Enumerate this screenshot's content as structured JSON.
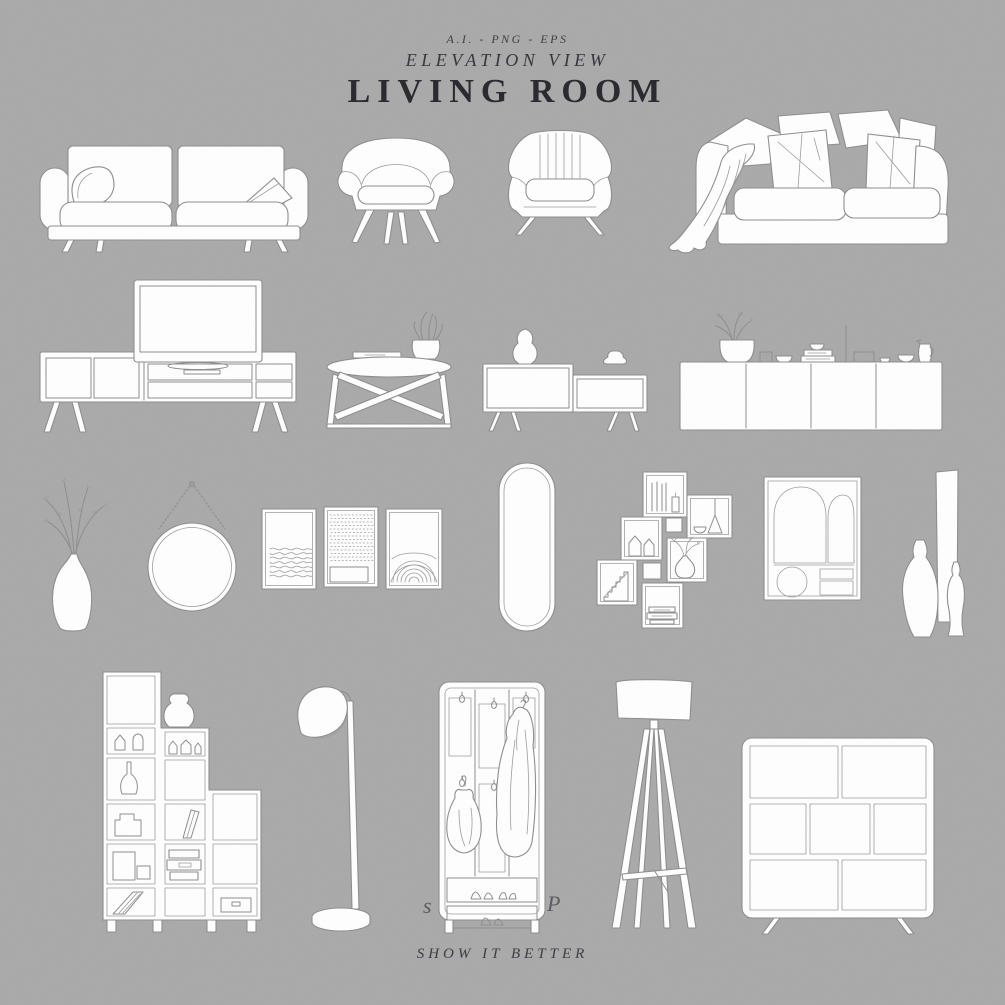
{
  "meta": {
    "width": 1005,
    "height": 1005
  },
  "colors": {
    "background": "#a9a9a9",
    "ink": "#2e2e34",
    "line": "#8d8d8d",
    "fill": "#ffffff"
  },
  "header": {
    "formats": "A.I. - PNG - EPS",
    "subtitle": "ELEVATION VIEW",
    "title": "LIVING ROOM"
  },
  "footer": {
    "brand": "SHOW IT BETTER"
  },
  "watermark": {
    "left_fragment": "s",
    "right_fragment": "P"
  },
  "items": [
    {
      "name": "three-seat-sofa"
    },
    {
      "name": "accent-armchair"
    },
    {
      "name": "channel-back-armchair"
    },
    {
      "name": "slipcover-sofa-with-throw"
    },
    {
      "name": "tv-stand-with-tv"
    },
    {
      "name": "round-coffee-table"
    },
    {
      "name": "two-tier-sideboard"
    },
    {
      "name": "long-sideboard-with-decor"
    },
    {
      "name": "vase-with-dried-branches"
    },
    {
      "name": "round-hanging-mirror"
    },
    {
      "name": "gallery-frames-trio"
    },
    {
      "name": "oval-floor-mirror"
    },
    {
      "name": "staggered-cube-shelf"
    },
    {
      "name": "abstract-art-frame"
    },
    {
      "name": "decorative-vases-group"
    },
    {
      "name": "stepped-bookshelf"
    },
    {
      "name": "dome-floor-lamp"
    },
    {
      "name": "hallway-coat-rack"
    },
    {
      "name": "tripod-floor-lamp"
    },
    {
      "name": "low-rounded-cabinet"
    }
  ]
}
